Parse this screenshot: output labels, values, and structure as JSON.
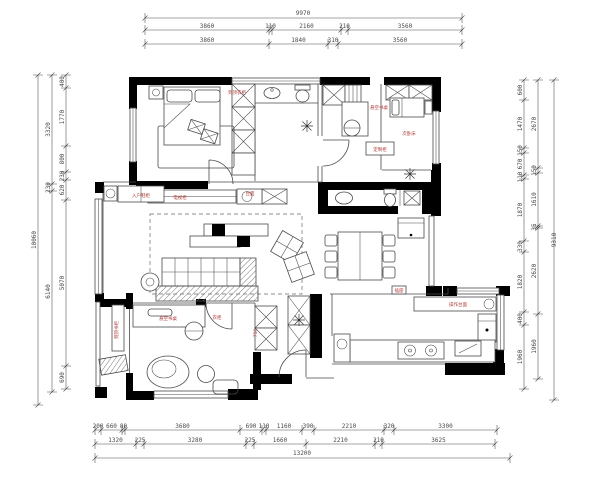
{
  "drawing": {
    "type": "residential floor plan (CAD)",
    "units": "mm",
    "colors": {
      "walls": "#000000",
      "lines": "#4a4a4a",
      "dimensions": "#4a4a4a",
      "annotations": "#b03a3a",
      "background": "#ffffff"
    }
  },
  "dimensions": {
    "top": {
      "total": "9970",
      "rows": [
        [
          "3860",
          "110",
          "2160",
          "210",
          "3560"
        ],
        [
          "3860",
          "1840",
          "310",
          "3560"
        ]
      ]
    },
    "bottom": {
      "total": "13200",
      "rows": [
        [
          "200",
          "660",
          "80",
          "3680",
          "690",
          "110",
          "1160",
          "390",
          "2210",
          "320",
          "3300"
        ],
        [
          "1320",
          "225",
          "3280",
          "225",
          "1660",
          "2210",
          "210",
          "3625"
        ]
      ]
    },
    "left": {
      "total": "10060",
      "rows": [
        [
          "3320",
          "230",
          "6140"
        ],
        [
          "400",
          "1770",
          "800",
          "230",
          "620",
          "5070",
          "690"
        ]
      ]
    },
    "right": {
      "total": "9310",
      "rows": [
        [
          "2670",
          "150",
          "1610",
          "35",
          "2620",
          "1960"
        ],
        [
          "600",
          "1470",
          "150",
          "670",
          "110",
          "1870",
          "330",
          "1820",
          "400",
          "1960"
        ]
      ]
    }
  },
  "annotations": [
    {
      "x": 237,
      "y": 94,
      "text": "到顶衣柜"
    },
    {
      "x": 379,
      "y": 109,
      "text": "悬空书桌"
    },
    {
      "x": 380,
      "y": 151,
      "text": "定制柜"
    },
    {
      "x": 409,
      "y": 135,
      "text": "次卧床"
    },
    {
      "x": 141,
      "y": 197,
      "text": "入户鞋柜"
    },
    {
      "x": 180,
      "y": 199,
      "text": "电视柜"
    },
    {
      "x": 250,
      "y": 195,
      "text": "台面"
    },
    {
      "x": 399,
      "y": 292,
      "text": "插座"
    },
    {
      "x": 458,
      "y": 306,
      "text": "操作台面"
    },
    {
      "x": 118,
      "y": 330,
      "text": "到顶书柜",
      "vertical": true
    },
    {
      "x": 168,
      "y": 320,
      "text": "悬空书桌"
    },
    {
      "x": 217,
      "y": 319,
      "text": "衣柜"
    },
    {
      "x": 257,
      "y": 333,
      "text": "750",
      "vertical": true
    }
  ],
  "symbols": {
    "ceiling-light-icon": "8-ray starburst",
    "door-swing-icon": "quarter-circle arc",
    "wardrobe-icon": "rectangle with X cross",
    "window-icon": "double parallel lines",
    "sliding-door-icon": "diagonal hatched rectangle"
  }
}
